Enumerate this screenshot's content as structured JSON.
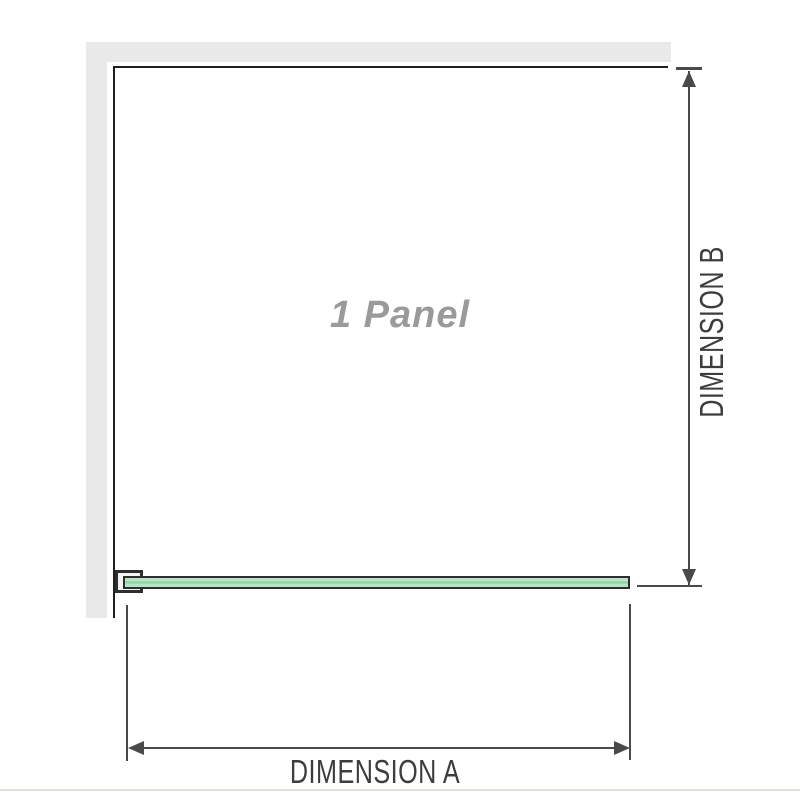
{
  "diagram": {
    "panel_label": "1 Panel",
    "dimension_a_label": "DIMENSION A",
    "dimension_b_label": "DIMENSION B",
    "colors": {
      "wall_fill": "#e9e9e9",
      "border": "#1f1f1f",
      "dimension_line": "#4a4a4a",
      "label_text": "#3d3d3d",
      "panel_label_text": "#9a9a9a",
      "glass_fill": "#b7e3c6",
      "glass_stripe": "#8ed1a6",
      "glass_outline": "#2e2e2e",
      "divider": "#e2e0da"
    }
  }
}
